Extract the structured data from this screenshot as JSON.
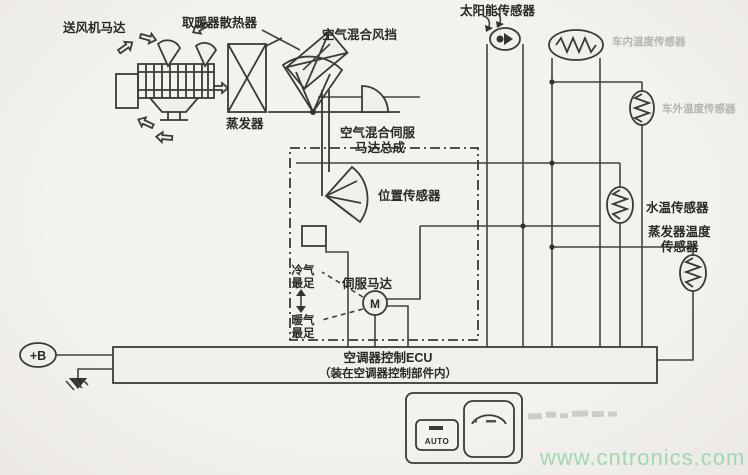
{
  "components": {
    "blower_motor": {
      "label": "送风机马达"
    },
    "heater_core": {
      "label": "取暖器散热器"
    },
    "air_mix_damper": {
      "label": "空气混合风挡"
    },
    "evaporator": {
      "label": "蒸发器"
    },
    "air_mix_servo_assembly": {
      "label_line1": "空气混合伺服",
      "label_line2": "马达总成"
    },
    "position_sensor": {
      "label": "位置传感器"
    },
    "servo_motor": {
      "label": "伺服马达",
      "symbol": "M"
    },
    "max_cool": {
      "line1": "冷气",
      "line2": "最足"
    },
    "max_heat": {
      "line1": "暖气",
      "line2": "最足"
    },
    "solar_sensor": {
      "label": "太阳能传感器"
    },
    "cabin_temp_sensor": {
      "label": "车内温度传感器"
    },
    "ambient_temp_sensor": {
      "label": "车外温度传感器"
    },
    "water_temp_sensor": {
      "label": "水温传感器"
    },
    "evaporator_temp_sensor": {
      "label_line1": "蒸发器温度",
      "label_line2": "传感器"
    },
    "ecu": {
      "title": "空调器控制ECU",
      "subtitle": "（装在空调器控制部件内）"
    },
    "battery_terminal": {
      "label": "+B"
    },
    "control_panel": {
      "auto_button_label": "AUTO"
    }
  },
  "watermark": {
    "text": "www.cntronics.com",
    "color": "#9fd8b0"
  }
}
